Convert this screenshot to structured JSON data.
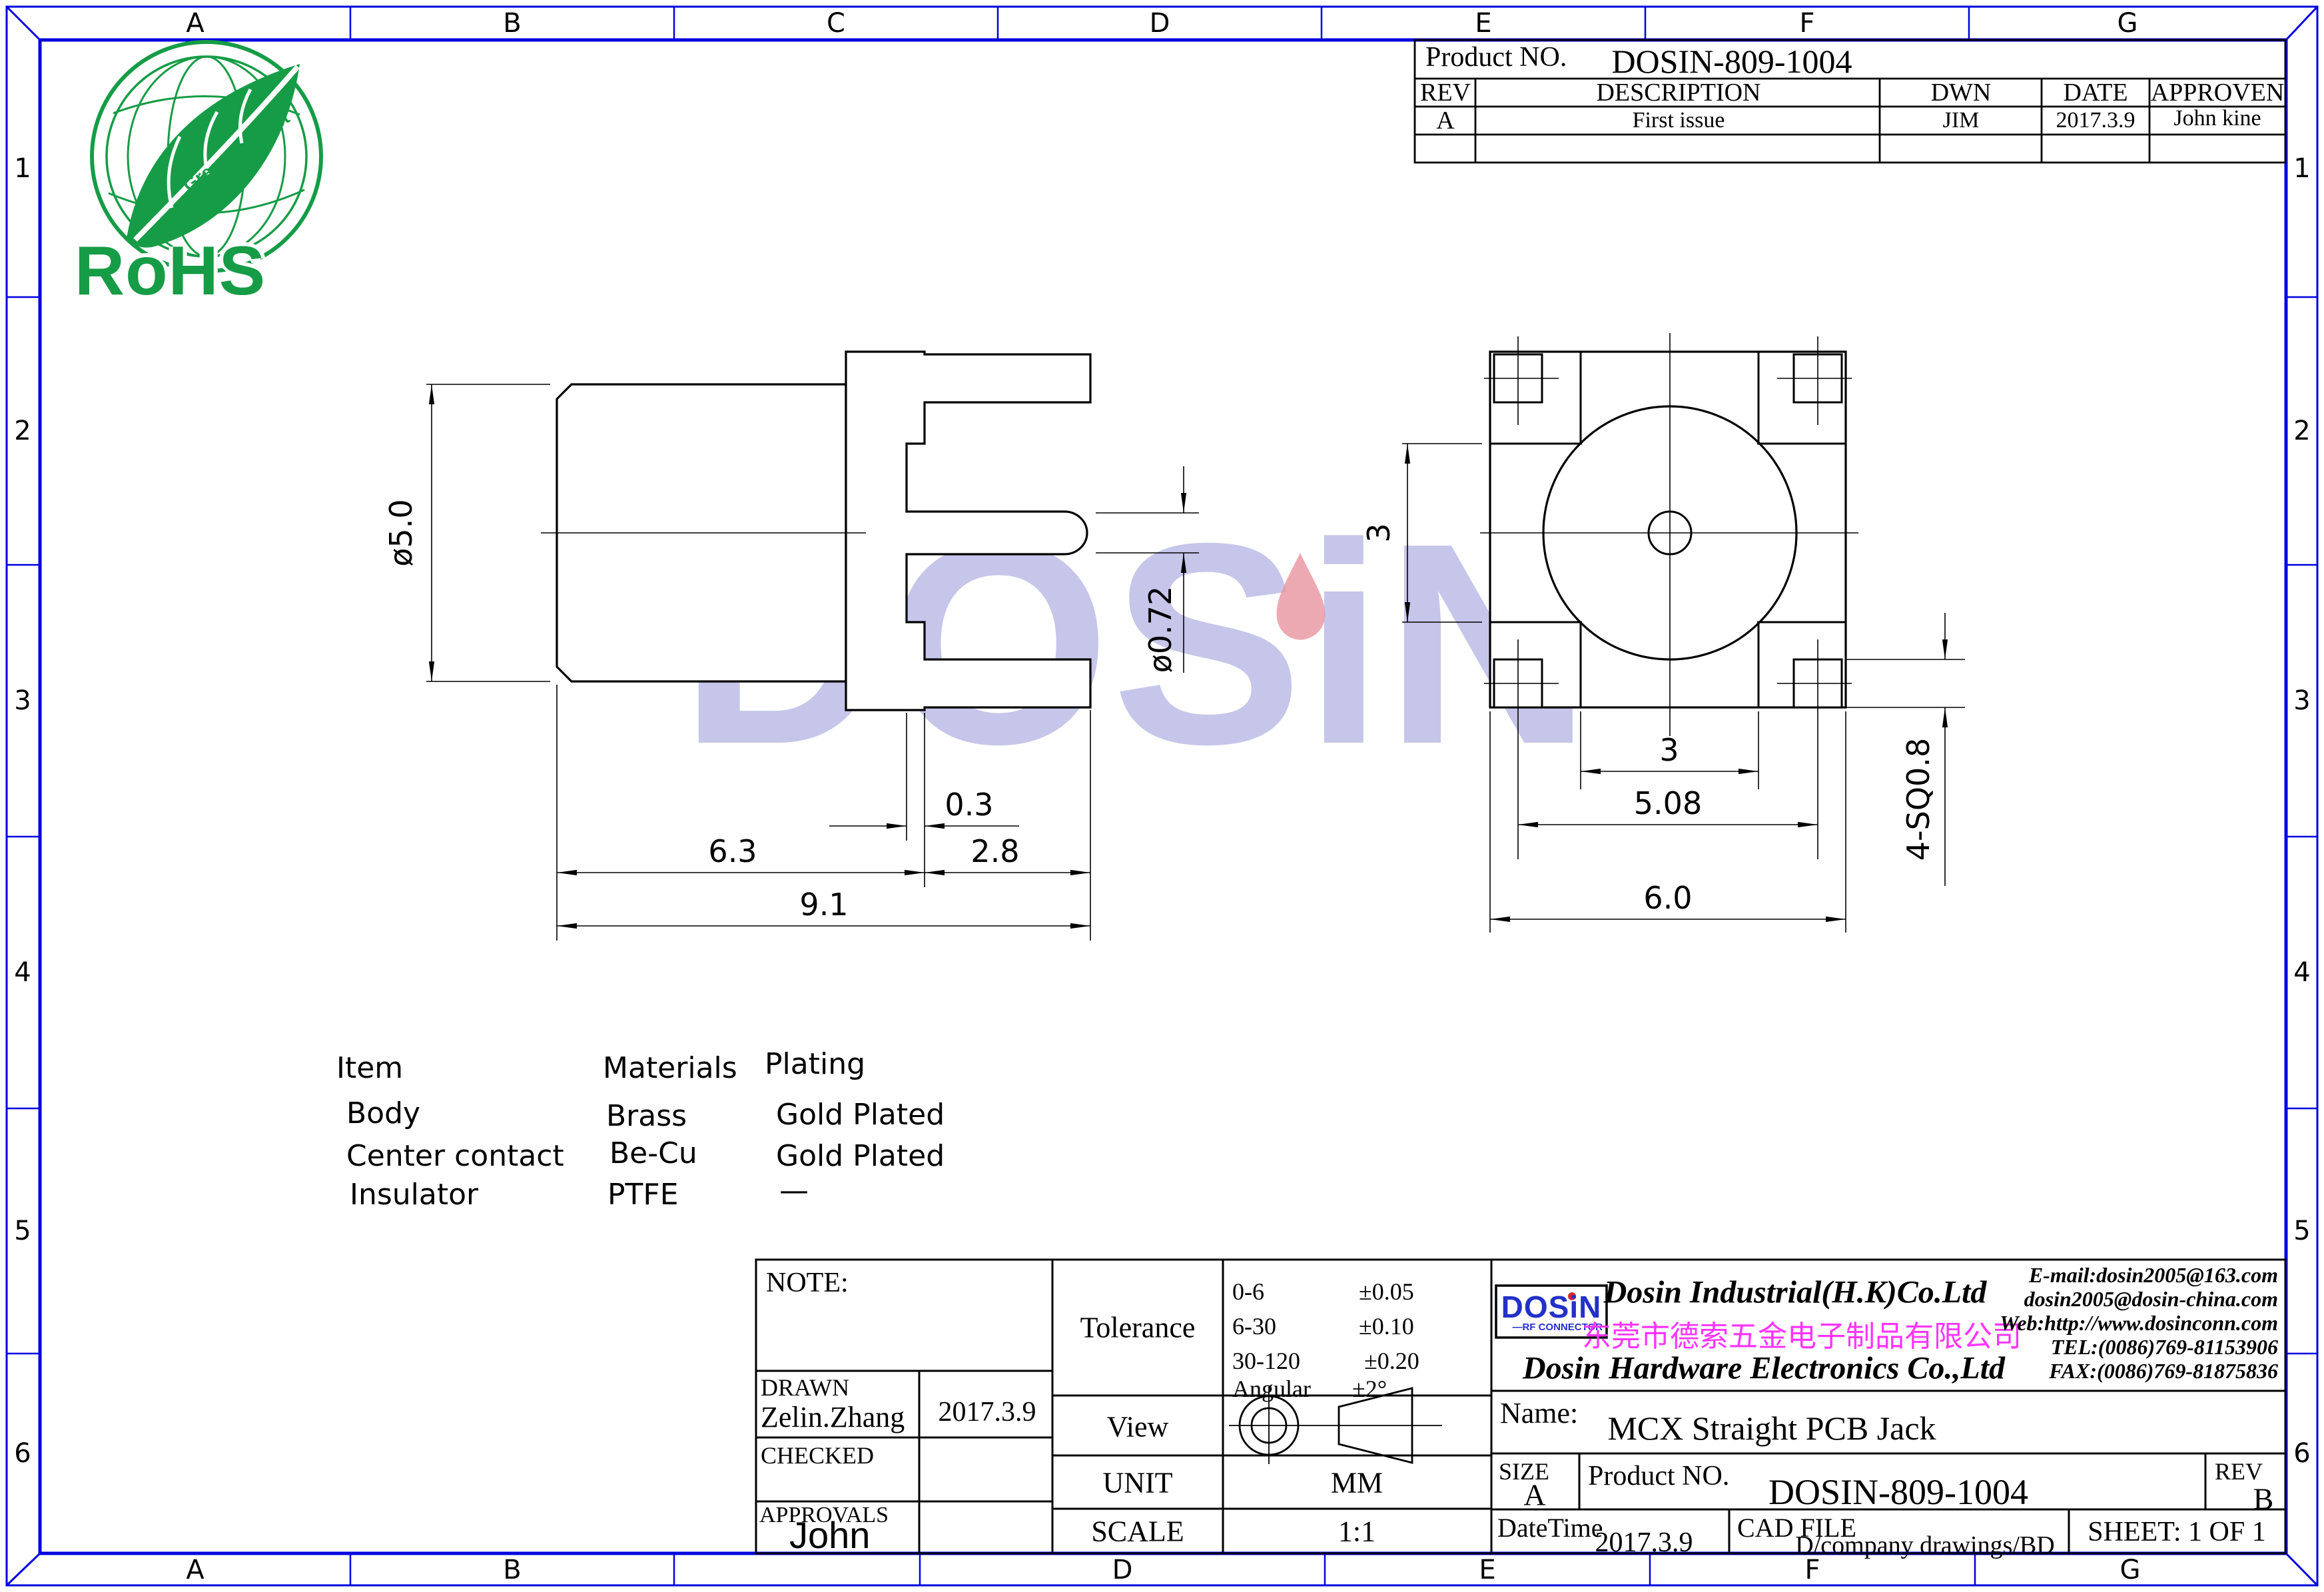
{
  "frame": {
    "top_labels": [
      "A",
      "B",
      "C",
      "D",
      "E",
      "F",
      "G"
    ],
    "bottom_labels": [
      "A",
      "B",
      "",
      "D",
      "E",
      "F",
      "G"
    ],
    "left_labels": [
      "1",
      "2",
      "3",
      "4",
      "5",
      "6"
    ],
    "right_labels": [
      "1",
      "2",
      "3",
      "4",
      "5",
      "6"
    ],
    "border_color": "#0000e0"
  },
  "rohs": {
    "title": "RoHS",
    "subtitle": "Green Product",
    "color": "#169c46"
  },
  "watermark": {
    "text": "DOSiN",
    "color": "#c6c6ea",
    "flame_color": "#e8939e"
  },
  "rev_table": {
    "product_label": "Product NO.",
    "product_value": "DOSIN-809-1004",
    "headers": [
      "REV",
      "DESCRIPTION",
      "DWN",
      "DATE",
      "APPROVEN"
    ],
    "rows": [
      [
        "A",
        "First issue",
        "JIM",
        "2017.3.9",
        "John kine"
      ],
      [
        "",
        "",
        "",
        "",
        ""
      ]
    ]
  },
  "materials": {
    "headers": [
      "Item",
      "Materials",
      "Plating"
    ],
    "rows": [
      [
        "Body",
        "Brass",
        "Gold Plated"
      ],
      [
        "Center contact",
        "Be-Cu",
        "Gold Plated"
      ],
      [
        "Insulator",
        "PTFE",
        "—"
      ]
    ]
  },
  "dimensions": {
    "side": {
      "dia": "ø5.0",
      "pin_dia": "ø0.72",
      "step": "0.3",
      "body_len": "6.3",
      "tail_len": "2.8",
      "total_len": "9.1"
    },
    "front": {
      "v3": "3",
      "h3": "3",
      "pitch": "5.08",
      "width": "6.0",
      "pins": "4-SQ0.8"
    }
  },
  "title_block": {
    "note_label": "NOTE:",
    "drawn_label": "DRAWN",
    "drawn_name": "Zelin.Zhang",
    "drawn_date": "2017.3.9",
    "checked_label": "CHECKED",
    "approvals_label": "APPROVALS",
    "approvals_name": "John",
    "tolerance_label": "Tolerance",
    "tolerance_rows": [
      [
        "0-6",
        "±0.05"
      ],
      [
        "6-30",
        "±0.10"
      ],
      [
        "30-120",
        "±0.20"
      ],
      [
        "Angular",
        "±2°"
      ]
    ],
    "view_label": "View",
    "unit_label": "UNIT",
    "unit_value": "MM",
    "scale_label": "SCALE",
    "scale_value": "1:1",
    "logo_text": "DOSiN",
    "logo_sub": "—RF CONNECTOR",
    "company_en1": "Dosin Industrial(H.K)Co.Ltd",
    "company_cn": "东莞市德索五金电子制品有限公司",
    "company_en2": "Dosin Hardware Electronics Co.,Ltd",
    "contact_lines": [
      "E-mail:dosin2005@163.com",
      "dosin2005@dosin-china.com",
      "Web:http://www.dosinconn.com",
      "TEL:(0086)769-81153906",
      "FAX:(0086)769-81875836"
    ],
    "name_label": "Name:",
    "name_value": "MCX Straight PCB Jack",
    "size_label": "SIZE",
    "size_value": "A",
    "product_label": "Product NO.",
    "product_value": "DOSIN-809-1004",
    "rev_label": "REV",
    "rev_value": "B",
    "datetime_label": "DateTime",
    "datetime_value": "2017.3.9",
    "cad_label": "CAD FILE",
    "cad_value": "D/company drawings/BD",
    "sheet_label": "SHEET:  1 OF 1"
  }
}
